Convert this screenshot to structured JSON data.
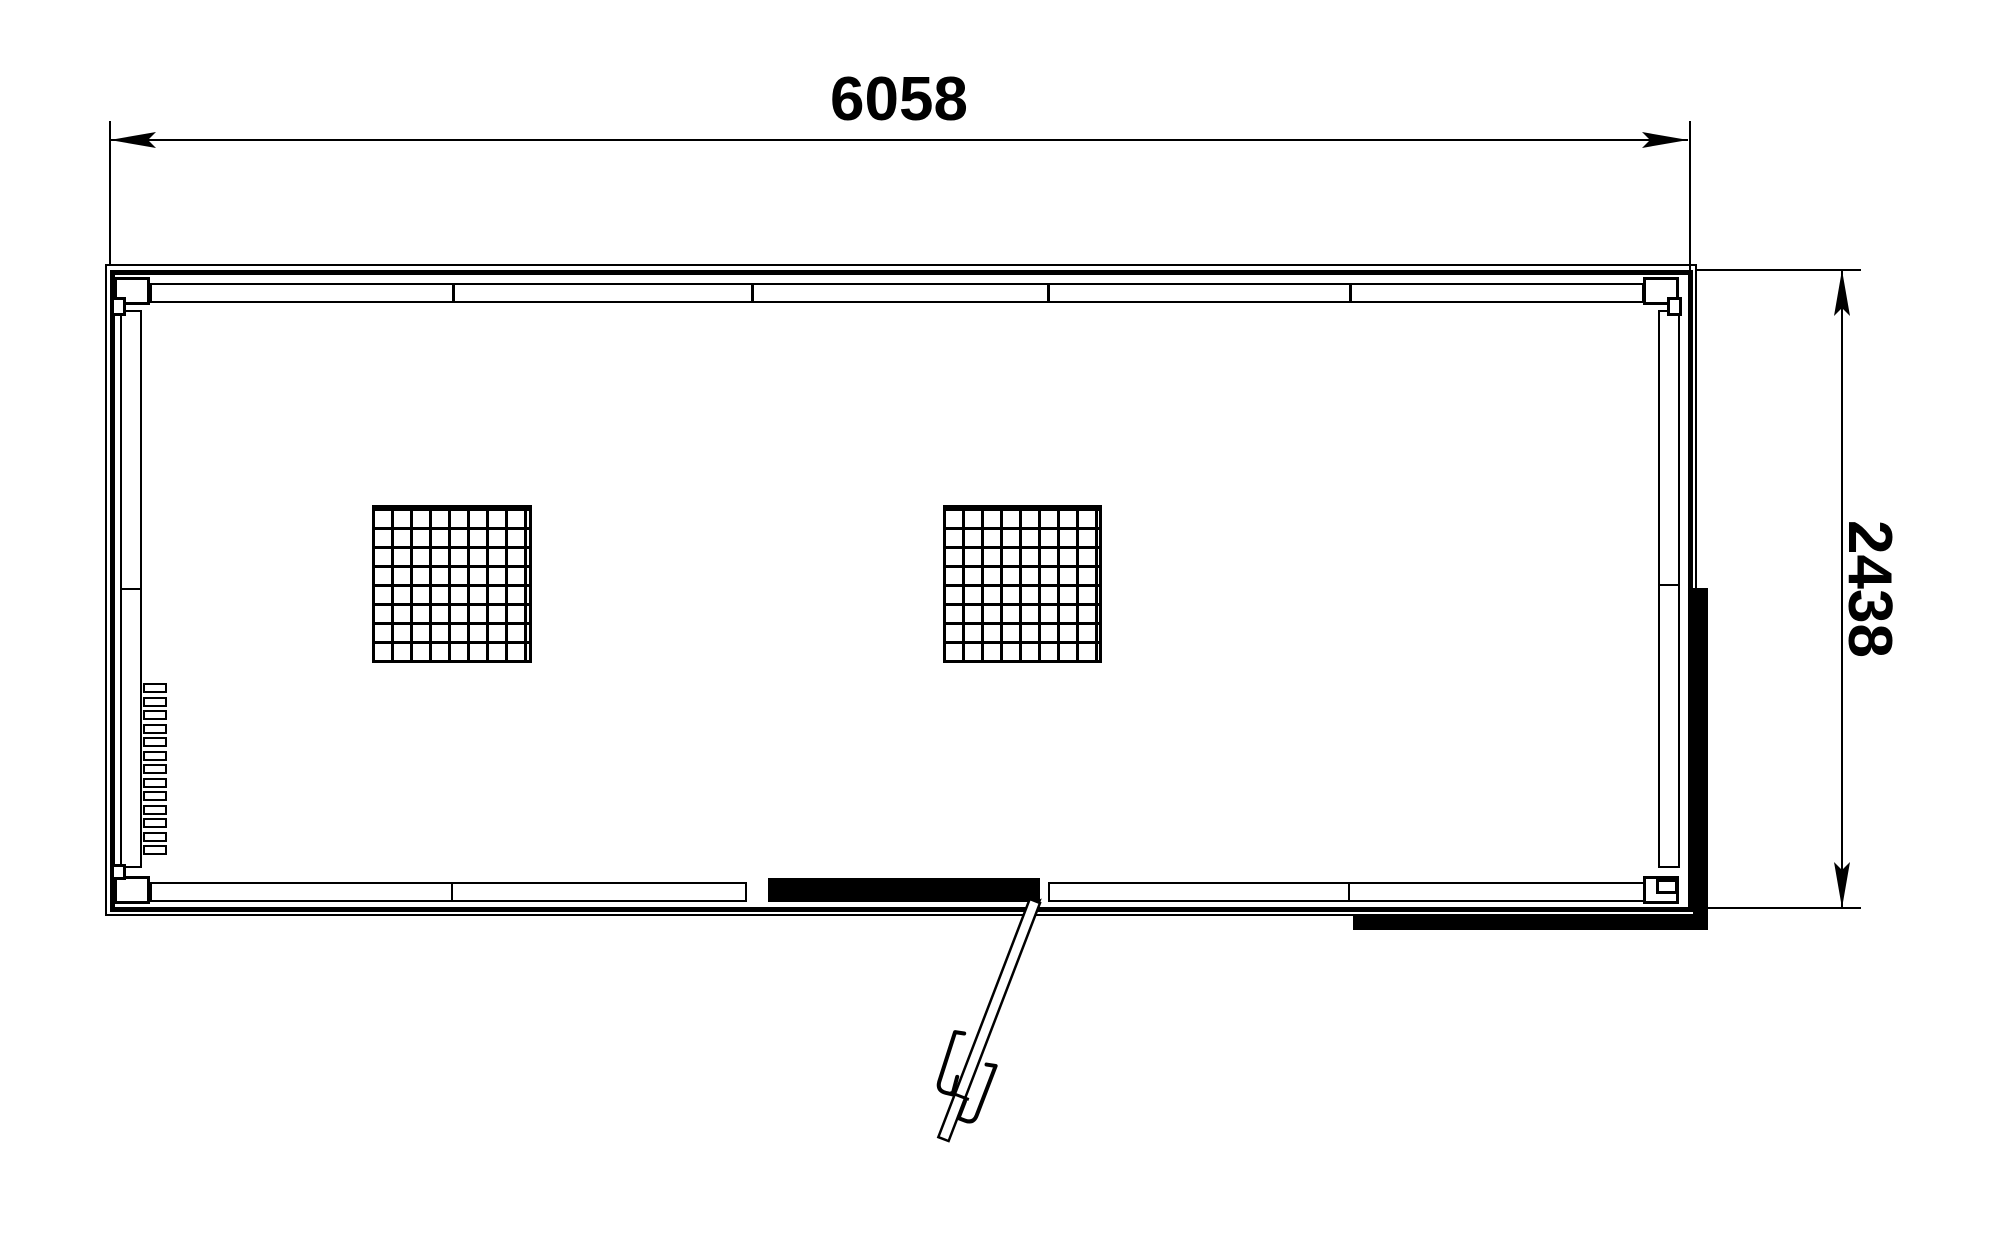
{
  "colors": {
    "line": "#000000",
    "bg": "#ffffff"
  },
  "dimensions": {
    "width": {
      "label": "6058"
    },
    "height": {
      "label": "2438"
    }
  }
}
